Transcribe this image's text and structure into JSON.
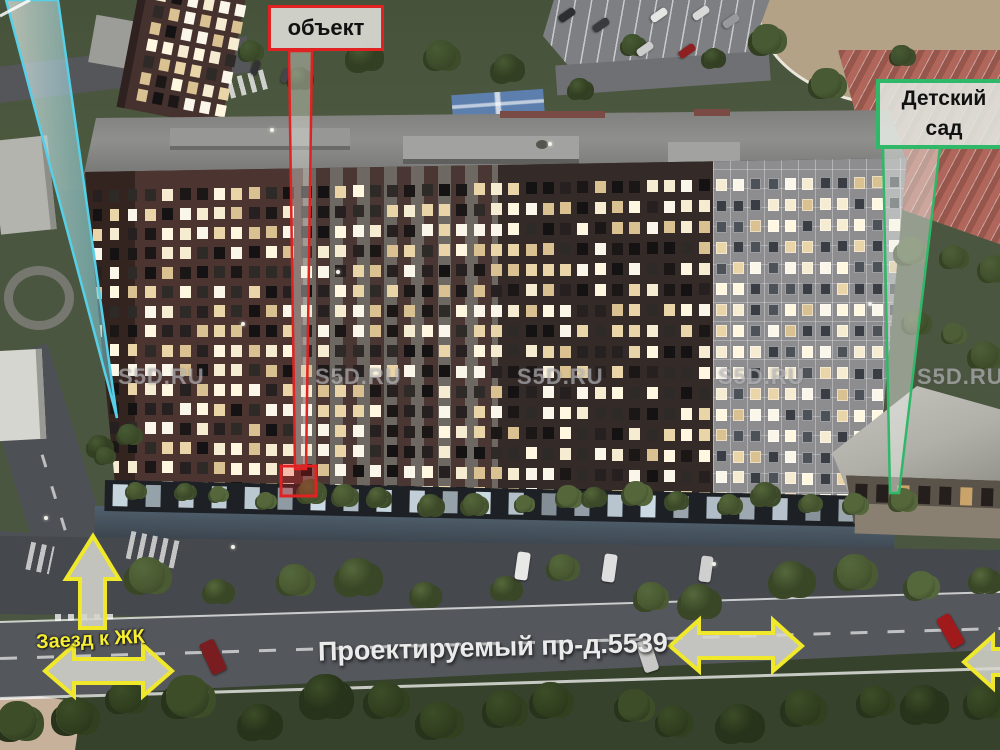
{
  "annotations": {
    "object_label": {
      "text": "объект",
      "border_color": "#e02222"
    },
    "kindergarten_label": {
      "line1": "Детский",
      "line2": "сад",
      "border_color": "#2fb868"
    },
    "entrance_text": {
      "text": "Заезд к ЖК",
      "color": "#f5ed33"
    },
    "road_text": {
      "text": "Проектируемый пр-д.5539",
      "color": "#ebebeb"
    },
    "pointer_colors": {
      "object": "#e02222",
      "kindergarten": "#2fb868",
      "offscreen_left": "#55d0e8",
      "arrows": "#f0e82b"
    }
  },
  "watermarks": {
    "text": "S5D.RU",
    "positions_x": [
      118,
      315,
      517,
      718,
      917
    ],
    "y": 364
  },
  "scene": {
    "window_lit_colors": [
      "#f6ecd2",
      "#fff7e0",
      "#e9d5a8",
      "#fbf6ea",
      "#d9c191"
    ],
    "window_dark_colors": [
      "#1c1717",
      "#262020",
      "#141212",
      "#2e2a28"
    ],
    "gray_section_dark_colors": [
      "#4d5158",
      "#3a3e44"
    ],
    "storefront_color": "#d6e5ef",
    "facade": {
      "cols": 47,
      "rows": 16,
      "lit_probability": 0.56
    },
    "tower": {
      "cols": 6,
      "rows": 7,
      "lit_probability": 0.7
    },
    "storefronts": {
      "count": 23,
      "step": 33
    },
    "kindergarten_window_color": "#241f1c",
    "kindergarten_lit_color": "#caa36a",
    "tree_rows": [
      {
        "y": 497,
        "jy": 8,
        "x0": 135,
        "x1": 895,
        "count": 19,
        "rmin": 8,
        "rmax": 13,
        "palette": [
          "#46552f",
          "#54663a",
          "#3c4a29"
        ]
      },
      {
        "y": 583,
        "jy": 18,
        "x0": 150,
        "x1": 990,
        "count": 13,
        "rmin": 12,
        "rmax": 19,
        "palette": [
          "#4a5a32",
          "#55683c",
          "#394726"
        ]
      },
      {
        "y": 713,
        "jy": 22,
        "x0": 10,
        "x1": 990,
        "count": 17,
        "rmin": 14,
        "rmax": 22,
        "palette": [
          "#31401f",
          "#3c4d28",
          "#27331a"
        ]
      },
      {
        "y": 60,
        "jy": 35,
        "x0": 240,
        "x1": 900,
        "count": 11,
        "rmin": 9,
        "rmax": 16,
        "palette": [
          "#3d4d2b",
          "#475a33",
          "#333f22"
        ]
      },
      {
        "y": 300,
        "jy": 60,
        "x0": 912,
        "x1": 990,
        "count": 6,
        "rmin": 10,
        "rmax": 16,
        "palette": [
          "#42512e",
          "#4e5f37",
          "#364322"
        ]
      },
      {
        "y": 450,
        "jy": 20,
        "x0": 105,
        "x1": 125,
        "count": 3,
        "rmin": 8,
        "rmax": 12,
        "palette": [
          "#3d4d2b",
          "#475a33",
          "#333f22"
        ]
      }
    ],
    "cars": [
      {
        "x": 516,
        "y": 552,
        "w": 13,
        "h": 28,
        "r": 8,
        "c": "#e8e8e6"
      },
      {
        "x": 603,
        "y": 554,
        "w": 13,
        "h": 28,
        "r": 8,
        "c": "#dedede"
      },
      {
        "x": 700,
        "y": 556,
        "w": 12,
        "h": 26,
        "r": 8,
        "c": "#cfcfcf"
      },
      {
        "x": 205,
        "y": 640,
        "w": 16,
        "h": 34,
        "r": -25,
        "c": "#7a1d20"
      },
      {
        "x": 640,
        "y": 640,
        "w": 15,
        "h": 32,
        "r": -18,
        "c": "#c8c8c6"
      },
      {
        "x": 943,
        "y": 614,
        "w": 15,
        "h": 34,
        "r": -30,
        "c": "#a01a1c"
      },
      {
        "x": 563,
        "y": 6,
        "w": 8,
        "h": 18,
        "r": 55,
        "c": "#2e2e30"
      },
      {
        "x": 597,
        "y": 16,
        "w": 8,
        "h": 18,
        "r": 55,
        "c": "#3a3a3c"
      },
      {
        "x": 655,
        "y": 6,
        "w": 8,
        "h": 18,
        "r": 55,
        "c": "#e5e5e3"
      },
      {
        "x": 697,
        "y": 4,
        "w": 8,
        "h": 18,
        "r": 55,
        "c": "#d8d8d6"
      },
      {
        "x": 683,
        "y": 42,
        "w": 8,
        "h": 18,
        "r": 55,
        "c": "#8f2022"
      },
      {
        "x": 641,
        "y": 40,
        "w": 8,
        "h": 18,
        "r": 55,
        "c": "#cccccc"
      },
      {
        "x": 727,
        "y": 12,
        "w": 8,
        "h": 18,
        "r": 55,
        "c": "#97999c"
      },
      {
        "x": 252,
        "y": 60,
        "w": 7,
        "h": 15,
        "r": 20,
        "c": "#333336"
      },
      {
        "x": 282,
        "y": 68,
        "w": 7,
        "h": 15,
        "r": 20,
        "c": "#46464a"
      }
    ],
    "lamp_dots": [
      [
        44,
        516
      ],
      [
        231,
        545
      ],
      [
        241,
        322
      ],
      [
        336,
        270
      ],
      [
        270,
        128
      ],
      [
        548,
        142
      ],
      [
        712,
        562
      ],
      [
        868,
        302
      ]
    ]
  }
}
